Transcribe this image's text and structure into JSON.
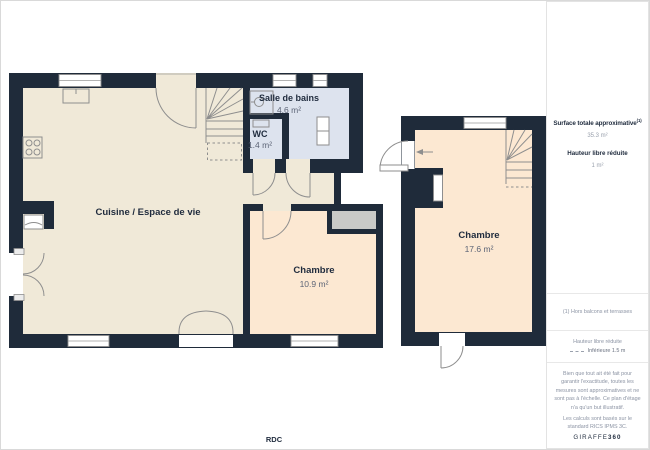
{
  "plan": {
    "floor_label": "RDC",
    "rooms": [
      {
        "id": "salle-de-bains",
        "name": "Salle de bains",
        "area": "4.6 m²"
      },
      {
        "id": "wc",
        "name": "WC",
        "area": "1.4 m²"
      },
      {
        "id": "cuisine",
        "name": "Cuisine / Espace de vie"
      },
      {
        "id": "chambre-1",
        "name": "Chambre",
        "area": "10.9 m²"
      },
      {
        "id": "chambre-2",
        "name": "Chambre",
        "area": "17.6 m²"
      }
    ],
    "colors": {
      "wall": "#1f2b3a",
      "living": "#f0e9d8",
      "bedroom": "#fce8d2",
      "bathroom": "#dde3ee",
      "closet": "#c9cac8"
    }
  },
  "sidebar": {
    "surface_title": "Surface totale approximative",
    "surface_title_sup": "(1)",
    "surface_value": "35.3 m²",
    "reduced_height_label": "Hauteur libre réduite",
    "reduced_height_value": "1 m²",
    "footnote": "(1) Hors balcons et terrasses",
    "legend_title": "Hauteur libre réduite",
    "legend_value": "Inférieure 1.5 m",
    "disclaimer": "Bien que tout ait été fait pour garantir l'exactitude, toutes les mesures sont approximatives et ne sont pas à l'échelle. Ce plan d'étage n'a qu'un but illustratif.",
    "standard_note": "Les calculs sont basés sur le standard RICS IPMS 3C.",
    "brand": "GIRAFFE",
    "brand_bold": "360"
  }
}
